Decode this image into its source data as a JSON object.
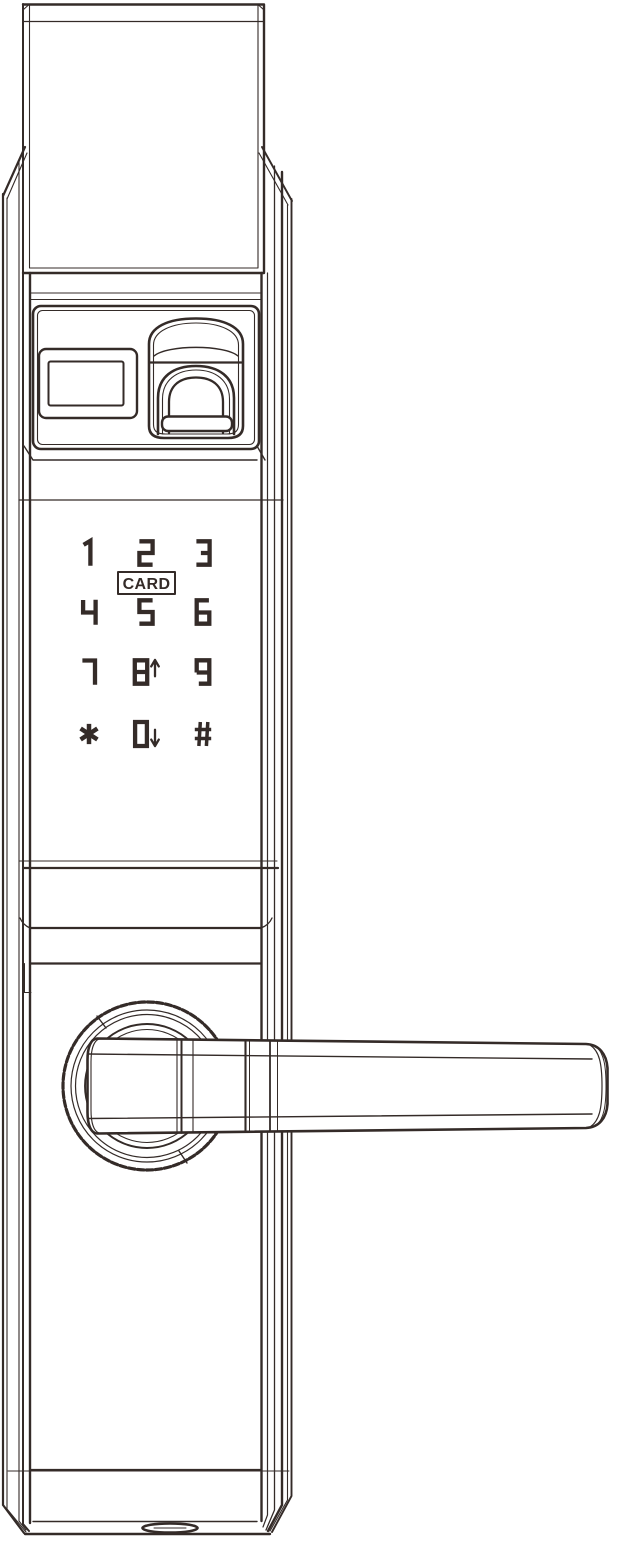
{
  "figure": {
    "kind": "line-drawing",
    "subject": "smart-door-lock-front-escutcheon"
  },
  "colors": {
    "ink": "#342b28",
    "paper": "#ffffff"
  },
  "keypad": {
    "card_label": "CARD",
    "keys": [
      {
        "label": "1",
        "row": 1,
        "col": 1
      },
      {
        "label": "2",
        "row": 1,
        "col": 2
      },
      {
        "label": "3",
        "row": 1,
        "col": 3
      },
      {
        "label": "4",
        "row": 2,
        "col": 1
      },
      {
        "label": "5",
        "row": 2,
        "col": 2
      },
      {
        "label": "6",
        "row": 2,
        "col": 3
      },
      {
        "label": "7",
        "row": 3,
        "col": 1
      },
      {
        "label": "8",
        "row": 3,
        "col": 2,
        "arrow": "up"
      },
      {
        "label": "9",
        "row": 3,
        "col": 3
      },
      {
        "label": "*",
        "row": 4,
        "col": 1
      },
      {
        "label": "0",
        "row": 4,
        "col": 2,
        "arrow": "down"
      },
      {
        "label": "#",
        "row": 4,
        "col": 3
      }
    ]
  }
}
